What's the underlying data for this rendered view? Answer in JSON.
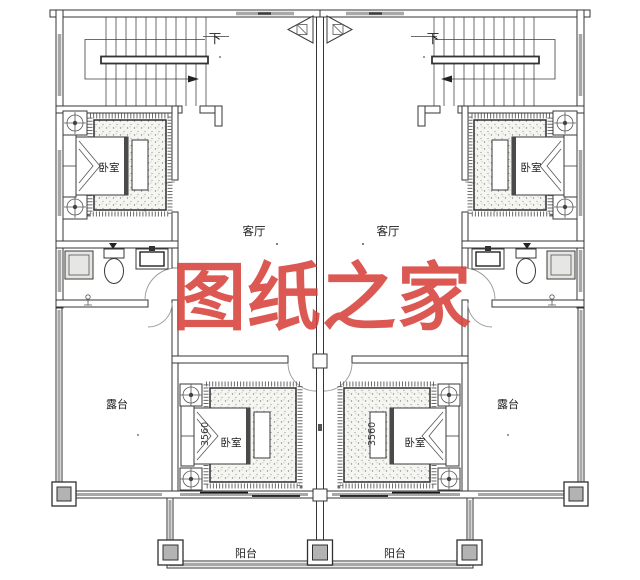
{
  "watermark": {
    "text": "图纸之家",
    "color": "#d8413c"
  },
  "labels": {
    "stair_down": "下",
    "bedroom": "卧室",
    "living_room": "客厅",
    "terrace": "露台",
    "balcony": "阳台"
  },
  "dimensions": {
    "bed_width": "3560"
  },
  "colors": {
    "background": "#ffffff",
    "line": "#353535",
    "window_gray": "#a8a8a8",
    "column_gray": "#b3b3b3",
    "watermark_red": "#d8413c"
  }
}
